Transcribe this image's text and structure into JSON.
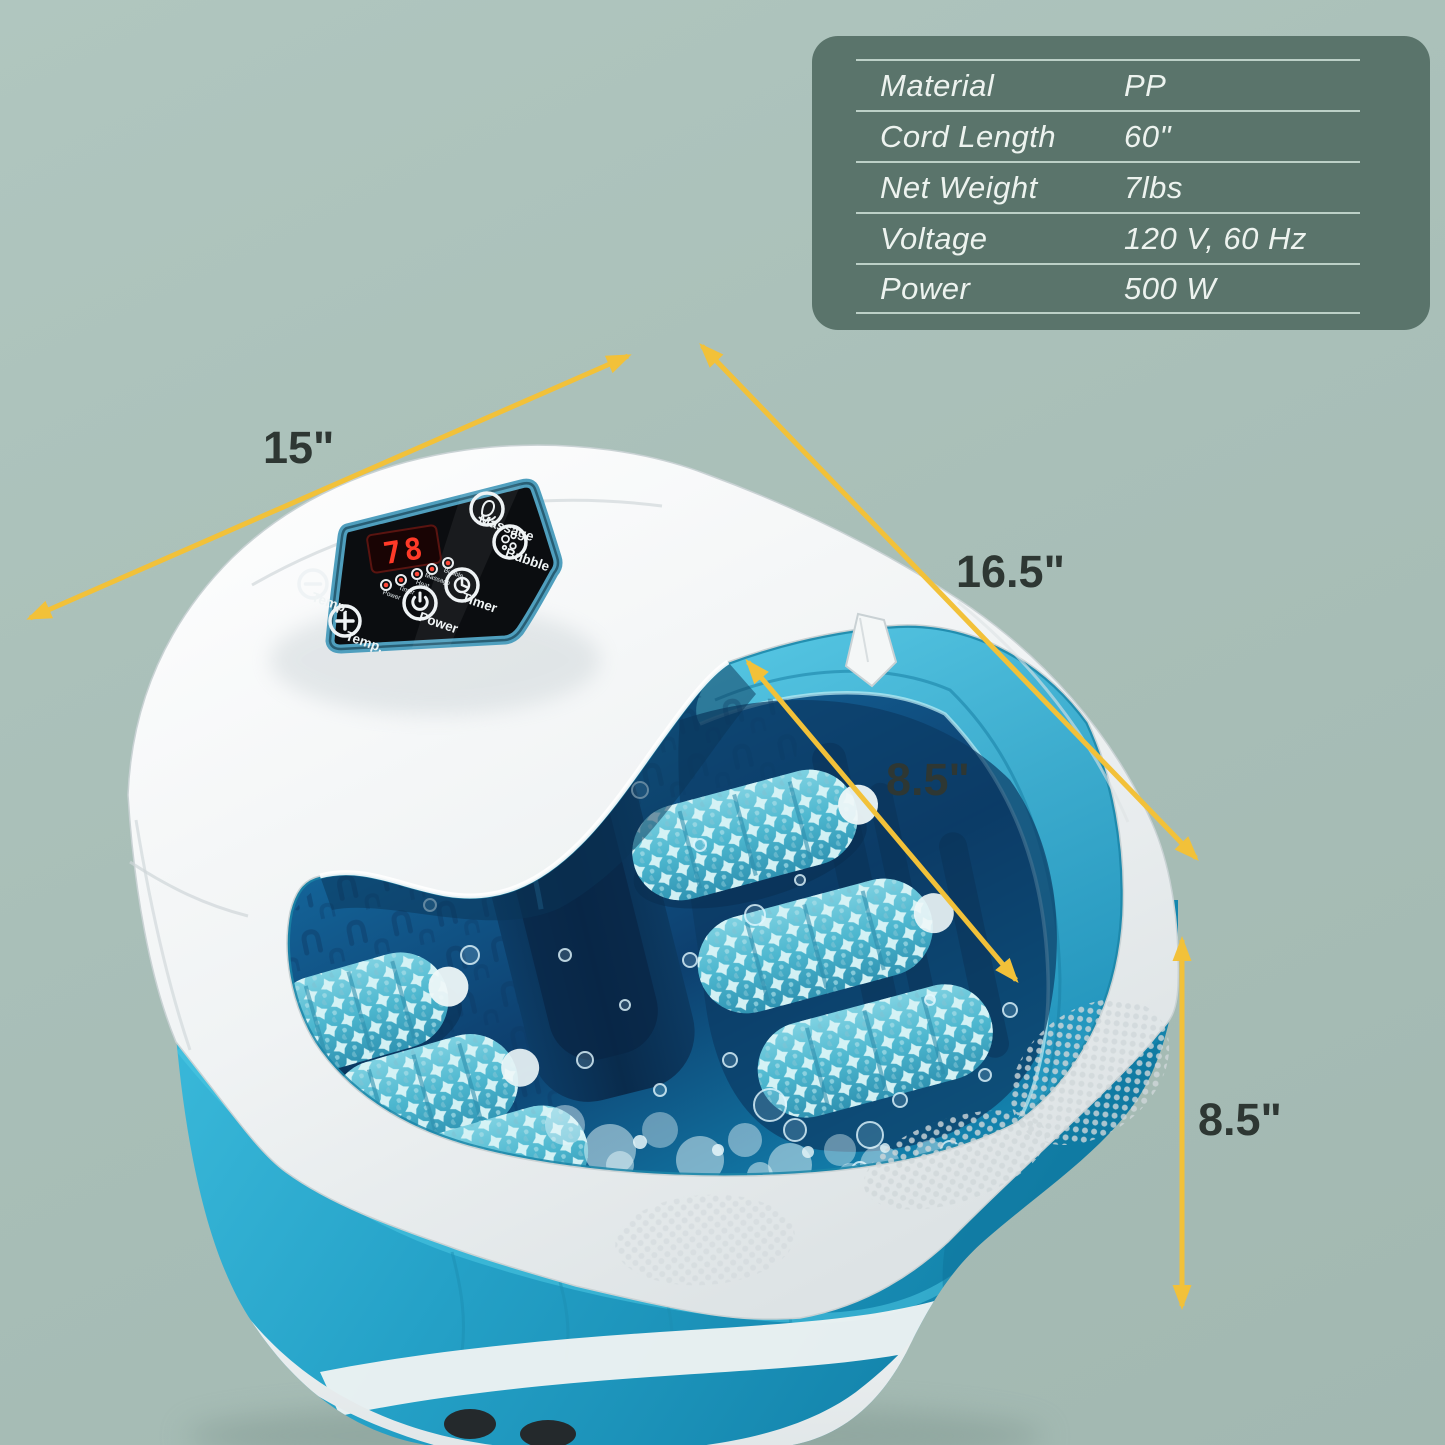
{
  "image_type": "product marketing photo with dimension annotations",
  "spec_table": {
    "rows": [
      {
        "label": "Material",
        "value": "PP"
      },
      {
        "label": "Cord Length",
        "value": "60\""
      },
      {
        "label": "Net Weight",
        "value": "7lbs"
      },
      {
        "label": "Voltage",
        "value": "120 V, 60 Hz"
      },
      {
        "label": "Power",
        "value": "500 W"
      }
    ],
    "bg_color": "#5a746b",
    "text_color": "#edf3ef",
    "line_color": "#cee0d7"
  },
  "dimensions": {
    "width_label": "15\"",
    "depth_label": "16.5\"",
    "inner_depth_label": "8.5\"",
    "height_label": "8.5\"",
    "arrow_color": "#f2c139",
    "label_color": "#2e3733"
  },
  "product": {
    "name": "foot spa bath massager with rollers",
    "panel": {
      "display_value": "78",
      "buttons": [
        {
          "icon": "minus-icon",
          "label": "Temp."
        },
        {
          "icon": "plus-icon",
          "label": "Temp."
        },
        {
          "icon": "power-icon",
          "label": "Power"
        },
        {
          "icon": "timer-icon",
          "label": "Timer"
        },
        {
          "icon": "massage-icon",
          "label": "Massage"
        },
        {
          "icon": "bubble-icon",
          "label": "Bubble"
        }
      ],
      "leds": [
        "Power",
        "Timer",
        "Heat",
        "Massage",
        "Bubble"
      ]
    },
    "colors": {
      "background": "#a9bfb8",
      "housing_white": "#f2f5f5",
      "body_teal": "#29a7cb",
      "tub_wall_teal": "#3cb6d6",
      "water_deep_blue": "#0d3f6e",
      "roller_cyan": "#bfe8ee",
      "panel_black": "#0b0d10",
      "panel_border_blue": "#4f9fbe",
      "display_red": "#ff3a28"
    }
  }
}
